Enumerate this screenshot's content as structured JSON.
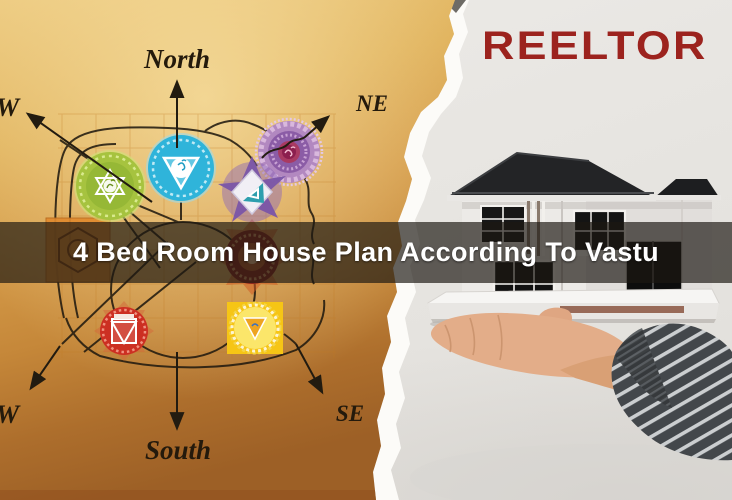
{
  "banner": {
    "title": "4 Bed Room House Plan According To Vastu",
    "text_color": "#ffffff",
    "overlay_color": "rgba(28,24,17,0.68)"
  },
  "brand": {
    "name": "REELTOR",
    "color": "#9c231e"
  },
  "vastu_chart": {
    "compass_labels": {
      "north": "North",
      "north_east": "NE",
      "south": "South",
      "south_east": "SE",
      "north_west_partial": "W",
      "south_west_partial": "W"
    },
    "paper_color": "#d49a48",
    "line_color": "#221b10",
    "chakra_icons": [
      {
        "name": "heart-chakra-icon",
        "color": "#a6c33f",
        "glyph": "यं"
      },
      {
        "name": "throat-chakra-icon",
        "color": "#2fb4da",
        "glyph": "हं"
      },
      {
        "name": "third-eye-chakra-icon",
        "color": "#7a55a8"
      },
      {
        "name": "crown-chakra-icon",
        "color": "#8b5ca6",
        "glyph": "ॐ"
      },
      {
        "name": "sacral-chakra-icon",
        "color": "#e18a2e"
      },
      {
        "name": "muladhara-flame-chakra-icon",
        "color": "#8e2a1e"
      },
      {
        "name": "root-chakra-icon",
        "color": "#cc2f22"
      },
      {
        "name": "solar-plexus-chakra-icon",
        "color": "#f6c515"
      }
    ]
  },
  "photo": {
    "scene_name": "hand-holding-miniature-house-model",
    "background_color": "#e8e6e2",
    "roof_color": "#232426",
    "sleeve_color": "#43474b"
  }
}
